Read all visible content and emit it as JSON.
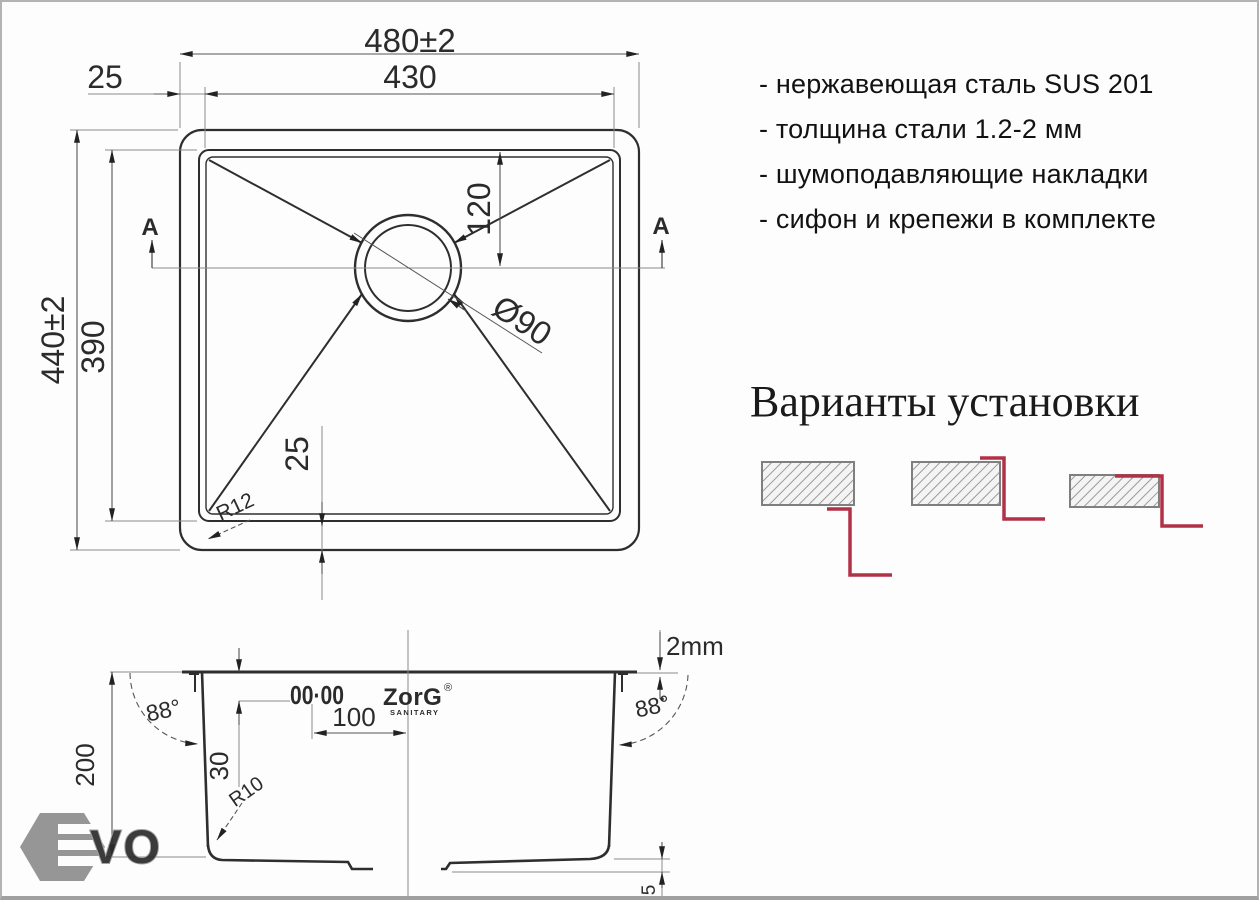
{
  "features": {
    "items": [
      "- нержавеющая сталь SUS 201",
      "- толщина стали 1.2-2 мм",
      "- шумоподавляющие накладки",
      "- сифон и крепежи в комплекте"
    ]
  },
  "installation": {
    "title": "Варианты установки",
    "options": [
      "undermount",
      "overmount",
      "flush-mount"
    ]
  },
  "top_view": {
    "dim_width_outer": "480±2",
    "dim_width_inner": "430",
    "dim_rim_top": "25",
    "dim_height_outer": "440±2",
    "dim_height_inner": "390",
    "dim_drain_offset": "120",
    "dim_drain_diameter": "Ø90",
    "dim_rim_bottom": "25",
    "dim_corner_radius": "R12",
    "section_label_left": "A",
    "section_label_right": "A"
  },
  "section_view": {
    "dim_rim_height": "2mm",
    "dim_wall_angle_left": "88°",
    "dim_wall_angle_right": "88°",
    "dim_depth": "200",
    "dim_hole_offset": "30",
    "dim_hole_spacing": "100",
    "dim_bottom_radius": "R10",
    "dim_drain_step": "5",
    "faucet_holes": "00·00",
    "logo_text": "ZorG",
    "logo_reg": "®",
    "logo_sub": "SANITARY"
  },
  "watermark": {
    "text": "VO"
  },
  "colors": {
    "drawing_line": "#2e2e2e",
    "dimension_line": "#8a8a8a",
    "dimension_text": "#2b2b2b",
    "accent_red": "#b13246",
    "hatch_gray": "#9a9a9a",
    "hatch_border": "#7f7f7f",
    "watermark_gray": "#8e8e8e"
  }
}
